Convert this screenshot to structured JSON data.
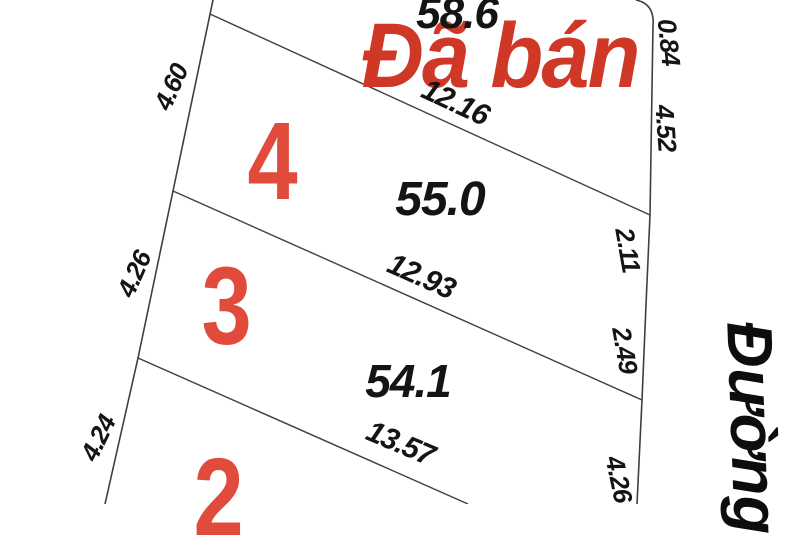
{
  "map": {
    "sold_stamp": "Đã bán",
    "street_label": "Đường",
    "areas": [
      "58.6",
      "55.0",
      "54.1"
    ],
    "plot_numbers": [
      "4",
      "3",
      "2"
    ],
    "frontage_dims": [
      "12.16",
      "12.93",
      "13.57"
    ],
    "left_side_dims": [
      "4.60",
      "4.26",
      "4.24"
    ],
    "road_side_dims": [
      "0.84",
      "4.52",
      "2.11",
      "2.49",
      "4.26"
    ],
    "colors": {
      "stamp_red": "#cf3727",
      "plot_number_red": "#e14b3c",
      "line_gray": "#3f3f3f",
      "text_black": "#141414",
      "background": "#ffffff"
    }
  }
}
